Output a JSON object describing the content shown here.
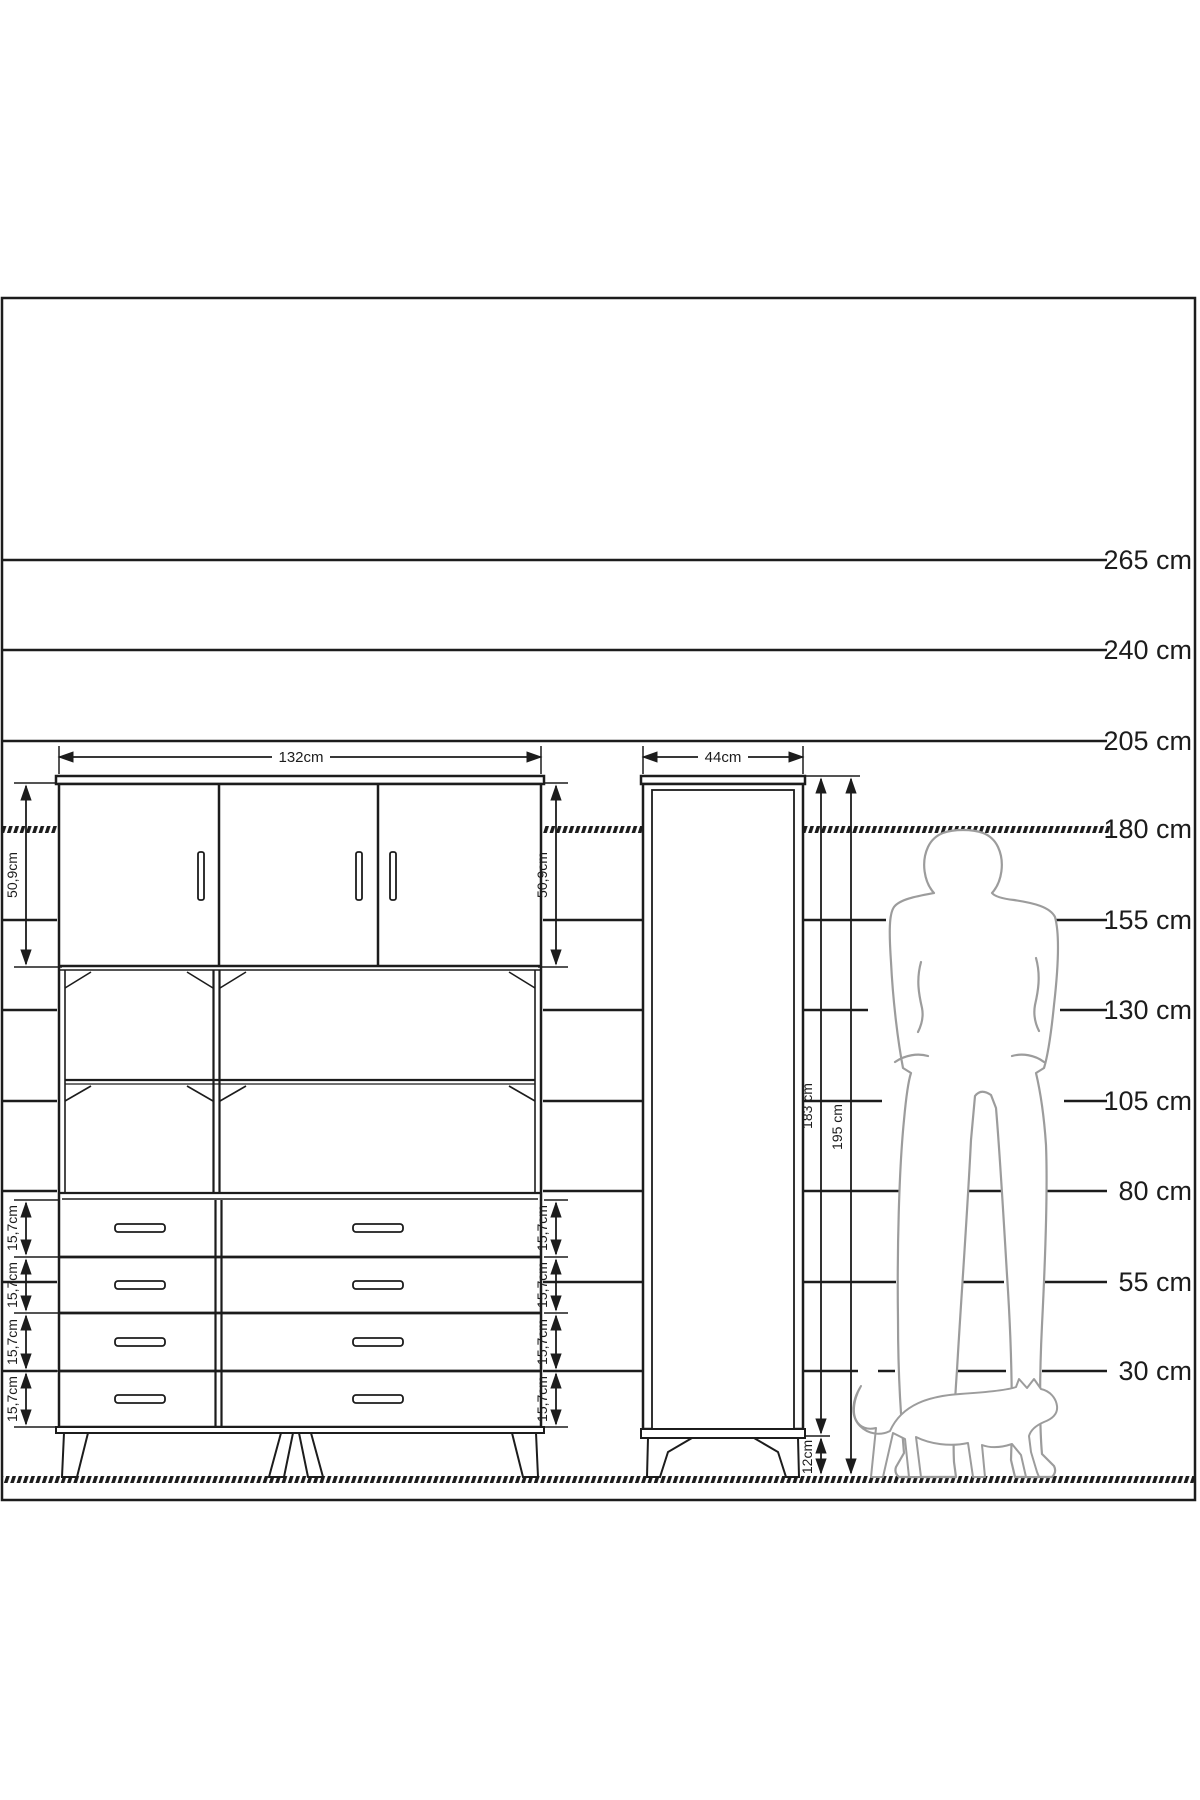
{
  "ruler": {
    "labels": [
      "265 cm",
      "240 cm",
      "205 cm",
      "180 cm",
      "155 cm",
      "130 cm",
      "105 cm",
      "80 cm",
      "55 cm",
      "30 cm"
    ]
  },
  "wide_cabinet": {
    "width_label": "132cm",
    "upper_height_label_left": "50,9cm",
    "upper_height_label_right": "50,9cm",
    "drawer_height_labels_left": [
      "15,7cm",
      "15,7cm",
      "15,7cm",
      "15,7cm"
    ],
    "drawer_height_labels_right": [
      "15,7cm",
      "15,7cm",
      "15,7cm",
      "15,7cm"
    ]
  },
  "tall_cabinet": {
    "width_label": "44cm",
    "body_height_label": "183 cm",
    "total_height_label": "195 cm",
    "leg_height_label": "12cm"
  },
  "colors": {
    "line": "#1c1c1c",
    "silhouette": "#9c9c9c",
    "background": "#ffffff"
  }
}
